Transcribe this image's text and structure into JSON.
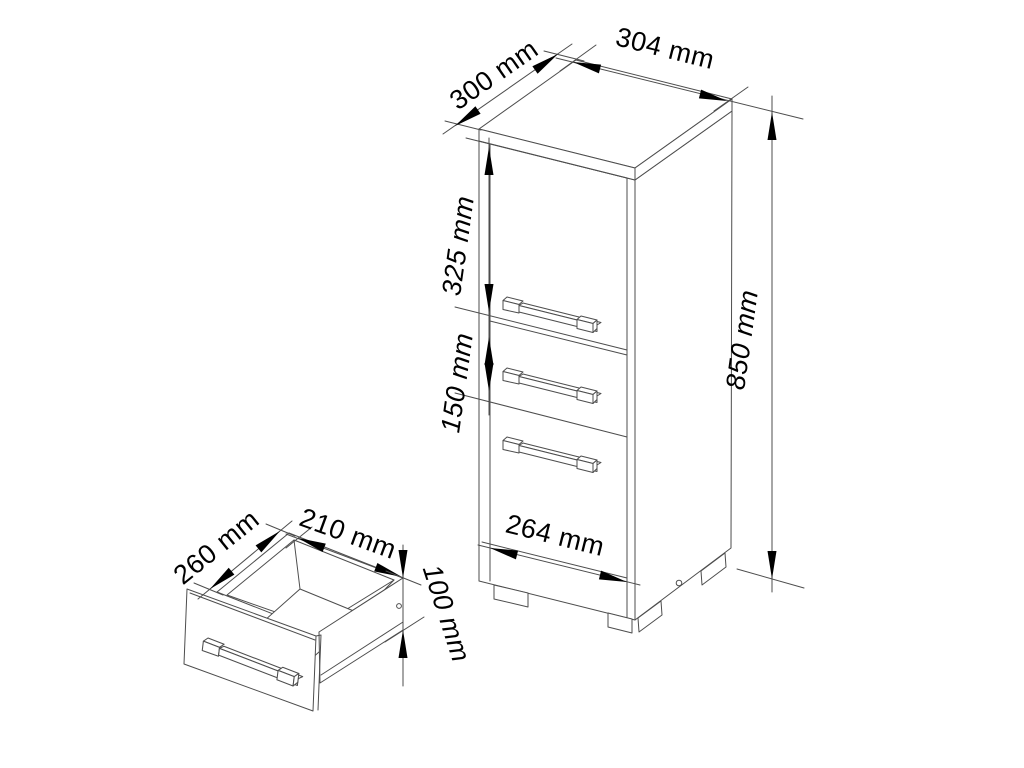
{
  "diagram": {
    "kind": "furniture-technical-drawing",
    "background_color": "#ffffff",
    "line_color": "#4d4d4d",
    "arrow_color": "#000000",
    "text_color": "#000000",
    "unit": "mm",
    "cabinet": {
      "top_depth": "300 mm",
      "top_width": "304 mm",
      "door_height": "325 mm",
      "middle_drawer_height": "150 mm",
      "total_height": "850 mm",
      "front_width": "264 mm"
    },
    "drawer": {
      "depth": "260 mm",
      "width": "210 mm",
      "front_height": "100 mm"
    }
  }
}
